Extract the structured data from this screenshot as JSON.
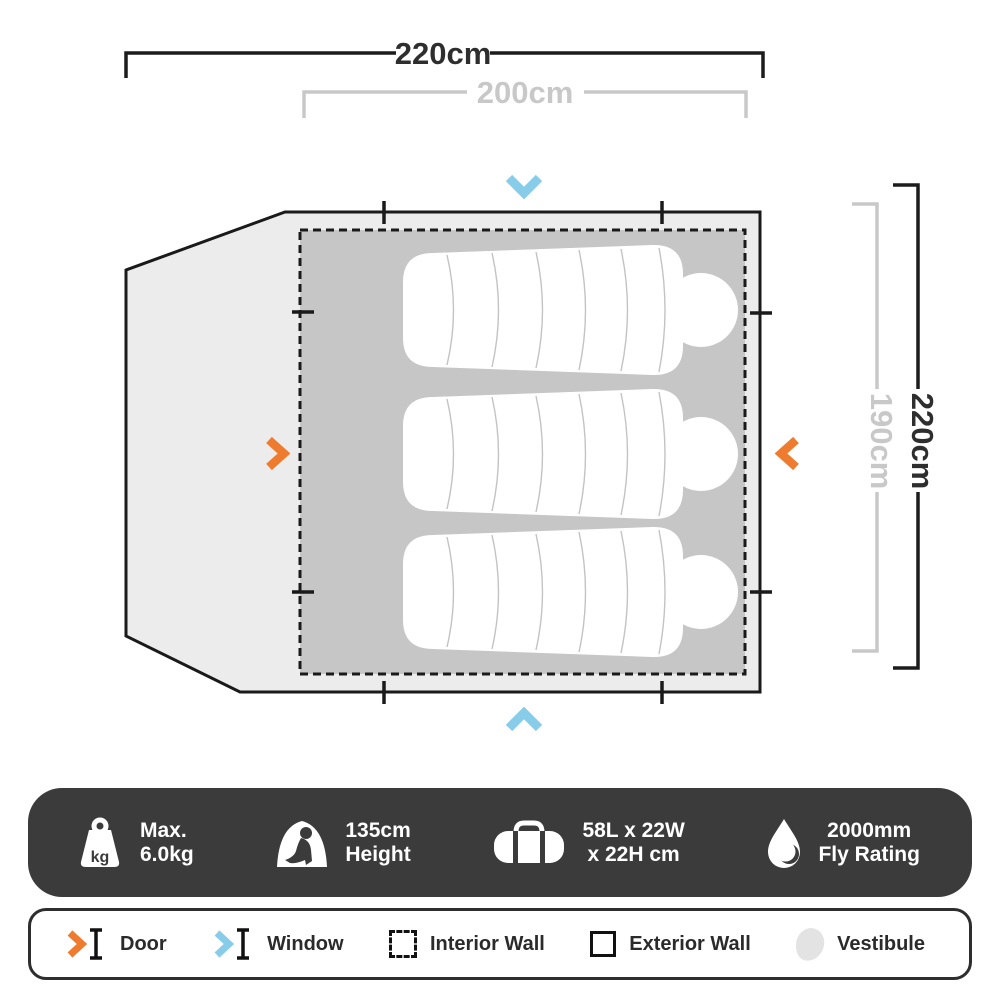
{
  "diagram": {
    "dim_top_outer": "220cm",
    "dim_top_inner": "200cm",
    "dim_right_outer": "220cm",
    "dim_right_inner": "190cm",
    "sleeping_bag_count": 3,
    "door_marker_color": "#EF7B2E",
    "window_marker_color": "#87CCE8",
    "interior_floor_color": "#C6C6C6",
    "exterior_floor_color": "#ECECEC",
    "outline_color": "#1A1A1A",
    "dim_secondary_color": "#C8C8C8",
    "dim_primary_color": "#2E2E2E"
  },
  "specs": {
    "bar_color": "#3B3B3B",
    "items": [
      {
        "icon": "weight-kg-icon",
        "badge": "kg",
        "line1": "Max.",
        "line2": "6.0kg"
      },
      {
        "icon": "peak-height-icon",
        "line1": "135cm",
        "line2": "Height"
      },
      {
        "icon": "packed-size-icon",
        "line1": "58L x 22W",
        "line2": "x 22H cm"
      },
      {
        "icon": "fly-rating-icon",
        "line1": "2000mm",
        "line2": "Fly Rating"
      }
    ]
  },
  "legend": {
    "items": [
      {
        "icon": "door-icon",
        "label": "Door"
      },
      {
        "icon": "window-icon",
        "label": "Window"
      },
      {
        "icon": "interior-wall-icon",
        "label": "Interior Wall"
      },
      {
        "icon": "exterior-wall-icon",
        "label": "Exterior Wall"
      },
      {
        "icon": "vestibule-icon",
        "label": "Vestibule"
      }
    ]
  }
}
